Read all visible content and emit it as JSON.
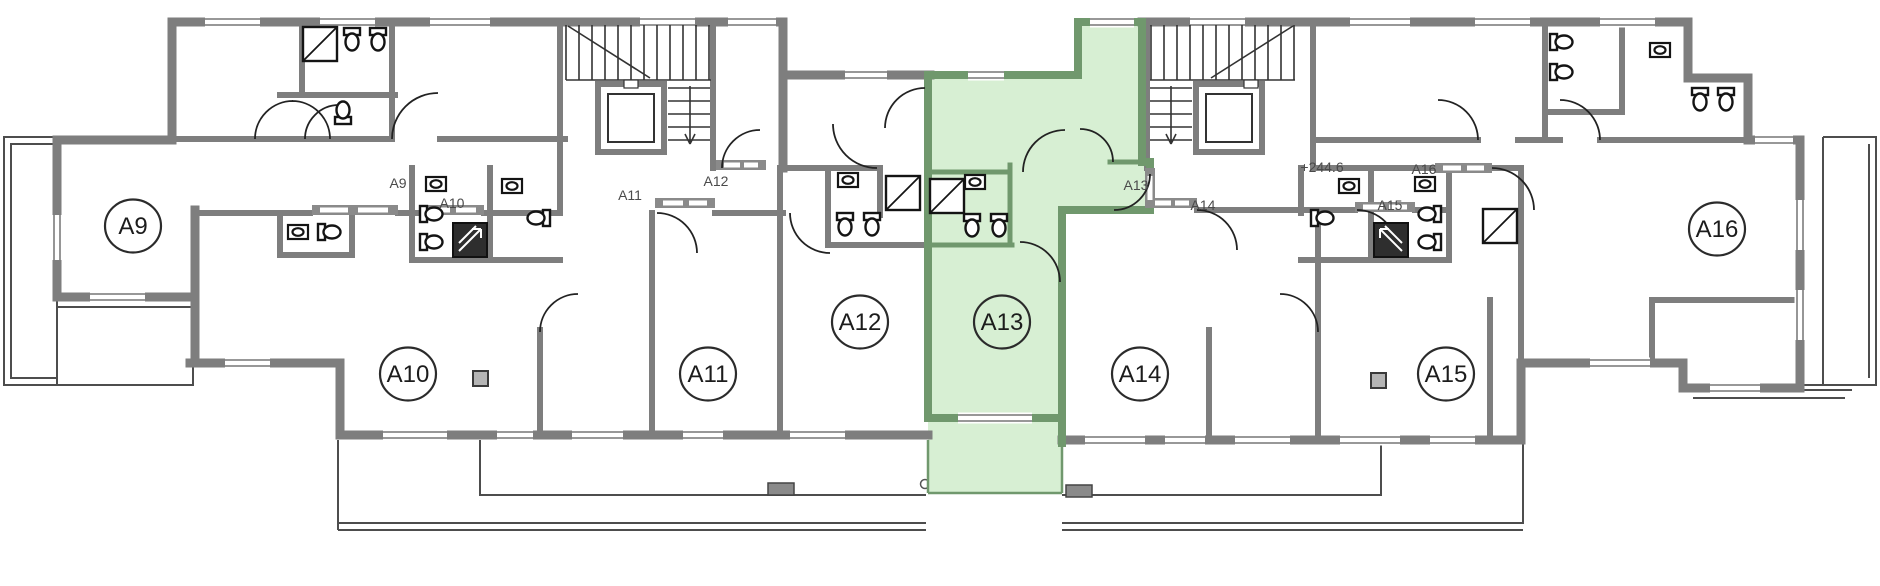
{
  "title": "Residential floor plan with units A9-A16, unit A13 highlighted",
  "plan": {
    "highlighted_unit": "A13",
    "elevation_label": "+244.6",
    "colors": {
      "highlight_fill": "#d7efd3",
      "highlight_wall": "#70986d",
      "wall_gray": "#7e7e7e",
      "fixture_line": "#141414",
      "label_gray": "#4a4a4a",
      "terrace_line": "#4d4d4d"
    },
    "units": [
      {
        "id": "A9",
        "bubble": "A9",
        "cx": 133,
        "cy": 226,
        "highlighted": false
      },
      {
        "id": "A10",
        "bubble": "A10",
        "cx": 408,
        "cy": 374,
        "highlighted": false
      },
      {
        "id": "A11",
        "bubble": "A11",
        "cx": 708,
        "cy": 374,
        "highlighted": false
      },
      {
        "id": "A12",
        "bubble": "A12",
        "cx": 860,
        "cy": 322,
        "highlighted": false
      },
      {
        "id": "A13",
        "bubble": "A13",
        "cx": 1002,
        "cy": 322,
        "highlighted": true
      },
      {
        "id": "A14",
        "bubble": "A14",
        "cx": 1140,
        "cy": 374,
        "highlighted": false
      },
      {
        "id": "A15",
        "bubble": "A15",
        "cx": 1446,
        "cy": 374,
        "highlighted": false
      },
      {
        "id": "A16",
        "bubble": "A16",
        "cx": 1717,
        "cy": 229,
        "highlighted": false
      }
    ],
    "door_labels": [
      {
        "text": "A9",
        "x": 398,
        "y": 188
      },
      {
        "text": "A10",
        "x": 452,
        "y": 208
      },
      {
        "text": "A11",
        "x": 630,
        "y": 200
      },
      {
        "text": "A12",
        "x": 716,
        "y": 186
      },
      {
        "text": "A13",
        "x": 1136,
        "y": 190
      },
      {
        "text": "A14",
        "x": 1203,
        "y": 210
      },
      {
        "text": "A15",
        "x": 1390,
        "y": 210
      },
      {
        "text": "A16",
        "x": 1424,
        "y": 174
      }
    ],
    "annotations": [
      {
        "text": "+244.6",
        "x": 1322,
        "y": 172
      }
    ]
  }
}
